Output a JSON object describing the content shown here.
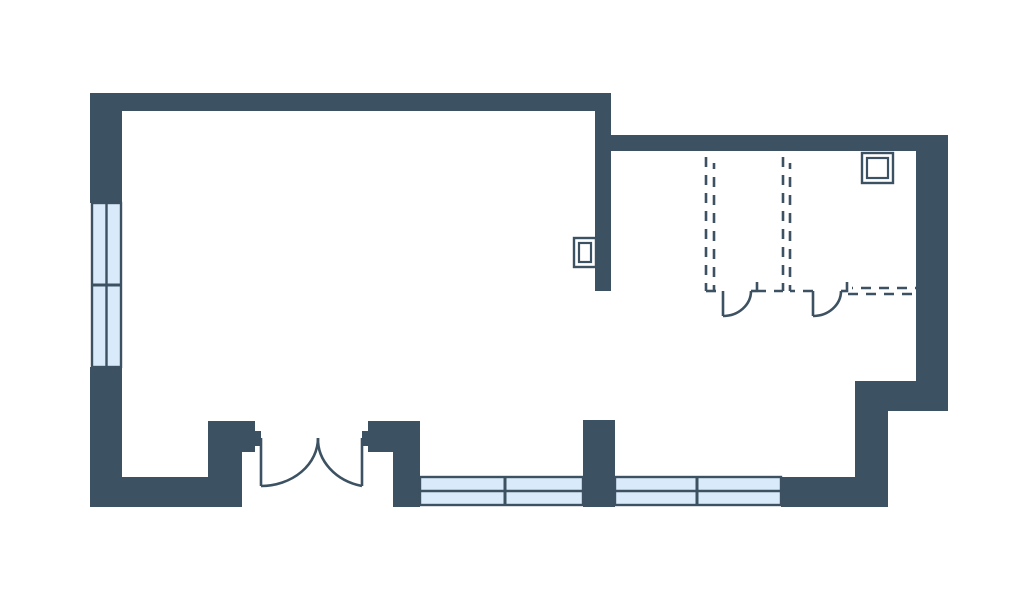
{
  "document": {
    "type": "architectural-floor-plan",
    "description": "Floor plan with large open room on left, secondary room on right with dashed partition walls, double entrance door, and windows"
  },
  "canvas": {
    "width": 1024,
    "height": 603,
    "background": "#ffffff"
  },
  "colors": {
    "wall": "#3c5161",
    "line": "#3c5161",
    "window_fill": "#d9eafa",
    "symbol_fill": "#ffffff"
  },
  "walls": [
    {
      "name": "wall-left-upper",
      "x": 90,
      "y": 93,
      "w": 32,
      "h": 110
    },
    {
      "name": "wall-left-lower",
      "x": 90,
      "y": 367,
      "w": 32,
      "h": 140
    },
    {
      "name": "wall-top",
      "x": 90,
      "y": 93,
      "w": 520,
      "h": 18
    },
    {
      "name": "wall-divider-vertical",
      "x": 595,
      "y": 93,
      "w": 16,
      "h": 198
    },
    {
      "name": "wall-top-right-section",
      "x": 610,
      "y": 135,
      "w": 338,
      "h": 16
    },
    {
      "name": "wall-right",
      "x": 916,
      "y": 135,
      "w": 32,
      "h": 276
    },
    {
      "name": "wall-step",
      "x": 855,
      "y": 381,
      "w": 93,
      "h": 30
    },
    {
      "name": "wall-right-lower",
      "x": 855,
      "y": 381,
      "w": 33,
      "h": 126
    },
    {
      "name": "wall-bottom-right",
      "x": 781,
      "y": 477,
      "w": 107,
      "h": 30
    },
    {
      "name": "wall-bottom-left",
      "x": 90,
      "y": 477,
      "w": 152,
      "h": 30
    },
    {
      "name": "door-jamb-left",
      "x": 208,
      "y": 421,
      "w": 47,
      "h": 31
    },
    {
      "name": "door-jamb-left-leg",
      "x": 208,
      "y": 449,
      "w": 34,
      "h": 58
    },
    {
      "name": "door-jamb-left-stub",
      "x": 255,
      "y": 431,
      "w": 6,
      "h": 15
    },
    {
      "name": "door-jamb-right",
      "x": 368,
      "y": 421,
      "w": 52,
      "h": 31
    },
    {
      "name": "door-jamb-right-stub",
      "x": 362,
      "y": 431,
      "w": 6,
      "h": 15
    },
    {
      "name": "door-jamb-right-leg",
      "x": 393,
      "y": 449,
      "w": 27,
      "h": 58
    },
    {
      "name": "wall-bottom-pier",
      "x": 583,
      "y": 420,
      "w": 32,
      "h": 87
    }
  ],
  "windows": [
    {
      "name": "window-left-wall",
      "x": 92,
      "y": 203,
      "w": 29,
      "h": 164,
      "orientation": "vertical",
      "cross": [
        285
      ]
    },
    {
      "name": "window-bottom-left",
      "x": 420,
      "y": 477,
      "w": 163,
      "h": 28,
      "orientation": "horizontal",
      "cross": [
        505
      ]
    },
    {
      "name": "window-bottom-right",
      "x": 615,
      "y": 477,
      "w": 166,
      "h": 28,
      "orientation": "horizontal",
      "cross": [
        697
      ]
    }
  ],
  "doors": [
    {
      "name": "entrance-double-door-left-leaf",
      "leaf": "M261,438 L261,486",
      "swing": "M261,486 A57,48 0 0 0 318,438",
      "ticks": []
    },
    {
      "name": "entrance-double-door-right-leaf",
      "leaf": "M362,438 L362,486",
      "swing": "M362,486 A57,48 0 0 1 318,438",
      "ticks": []
    },
    {
      "name": "interior-door-1",
      "leaf": "M723,291 L723,316",
      "swing": "M723,316 A28,25 0 0 0 751,291",
      "ticks": [
        {
          "x1": 751,
          "y1": 291,
          "x2": 758,
          "y2": 291
        },
        {
          "x1": 757,
          "y1": 282,
          "x2": 757,
          "y2": 292
        }
      ]
    },
    {
      "name": "interior-door-2",
      "leaf": "M813,291 L813,316",
      "swing": "M813,316 A28,25 0 0 0 841,291",
      "ticks": [
        {
          "x1": 841,
          "y1": 291,
          "x2": 848,
          "y2": 291
        },
        {
          "x1": 847,
          "y1": 282,
          "x2": 847,
          "y2": 292
        }
      ]
    }
  ],
  "dashed_lines": [
    {
      "name": "dashed-partition-1-line-a",
      "x1": 706,
      "y1": 157,
      "x2": 706,
      "y2": 291,
      "offset": 0
    },
    {
      "name": "dashed-partition-1-line-b",
      "x1": 714,
      "y1": 163,
      "x2": 714,
      "y2": 291,
      "offset": 4
    },
    {
      "name": "dashed-partition-2-line-a",
      "x1": 783,
      "y1": 157,
      "x2": 783,
      "y2": 291,
      "offset": 0
    },
    {
      "name": "dashed-partition-2-line-b",
      "x1": 790,
      "y1": 163,
      "x2": 790,
      "y2": 291,
      "offset": 4
    },
    {
      "name": "dashed-wall-segment-a",
      "x1": 706,
      "y1": 291,
      "x2": 723,
      "y2": 291,
      "offset": 0
    },
    {
      "name": "dashed-wall-segment-b",
      "x1": 758,
      "y1": 291,
      "x2": 783,
      "y2": 291,
      "offset": 2
    },
    {
      "name": "dashed-wall-segment-c",
      "x1": 790,
      "y1": 291,
      "x2": 813,
      "y2": 291,
      "offset": 5
    },
    {
      "name": "dashed-wall-segment-d-upper",
      "x1": 852,
      "y1": 288,
      "x2": 916,
      "y2": 288,
      "offset": 9
    },
    {
      "name": "dashed-wall-segment-d-lower",
      "x1": 848,
      "y1": 294,
      "x2": 916,
      "y2": 294,
      "offset": 0
    }
  ],
  "symbols": [
    {
      "name": "wall-box-symbol-left",
      "x": 574,
      "y": 238,
      "w": 22,
      "h": 29,
      "inset": 5
    },
    {
      "name": "wall-box-symbol-top-right",
      "x": 862,
      "y": 153,
      "w": 31,
      "h": 30,
      "inset": 5
    }
  ]
}
